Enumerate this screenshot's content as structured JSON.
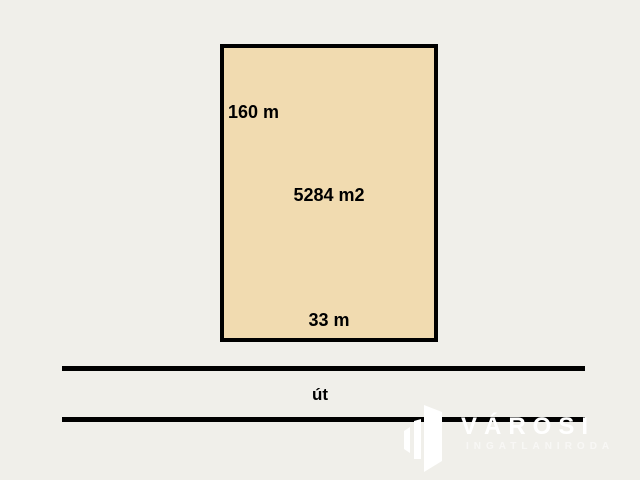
{
  "colors": {
    "background": "#F0EFEA",
    "plot-fill": "#F1DBB0",
    "line": "#000000",
    "logo": "#FFFFFF"
  },
  "plot": {
    "depth_label": "160 m",
    "area_label": "5284 m2",
    "frontage_label": "33 m"
  },
  "road": {
    "label": "út"
  },
  "logo": {
    "name": "VÁROSI",
    "subtitle": "INGATLANIRODA",
    "icon": "buildings-icon"
  }
}
